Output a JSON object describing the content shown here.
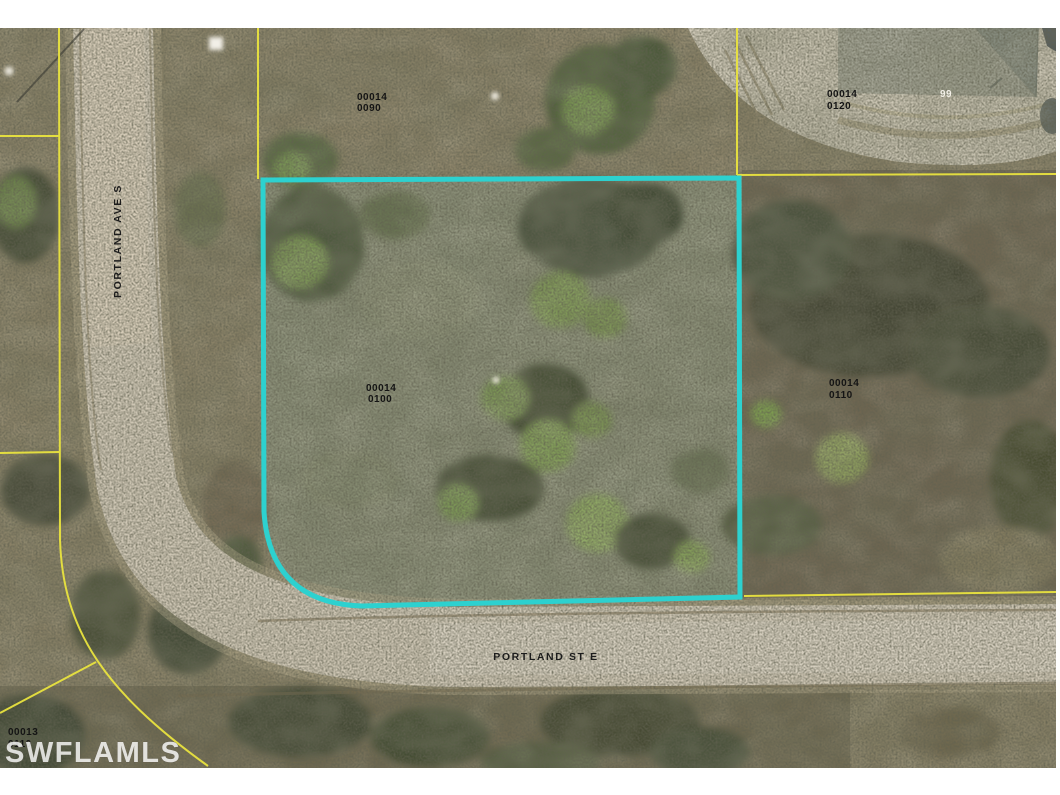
{
  "map": {
    "watermark": "SWFLAMLS",
    "house_number": "99",
    "streets": {
      "vertical": "PORTLAND AVE S",
      "horizontal": "PORTLAND ST E"
    },
    "parcel_labels": [
      {
        "id": "north",
        "line1": "00014",
        "line2": "0090"
      },
      {
        "id": "northeast",
        "line1": "00014",
        "line2": "0120"
      },
      {
        "id": "subject",
        "line1": "00014",
        "line2": "0100"
      },
      {
        "id": "east",
        "line1": "00014",
        "line2": "0110"
      },
      {
        "id": "southwest",
        "line1": "00013",
        "line2": "0110"
      }
    ],
    "colors": {
      "highlight_boundary": "#2dd1cf",
      "parcel_line": "#e9e33f"
    }
  }
}
